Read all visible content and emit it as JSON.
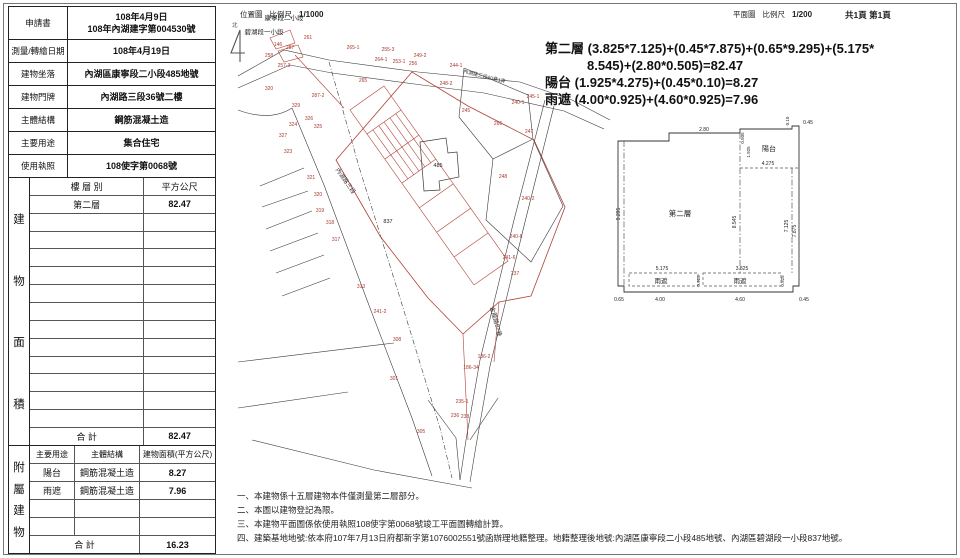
{
  "header": {
    "location_map": "位置圖",
    "scale_label": "比例尺",
    "location_scale": "1/1000",
    "plan_map": "平面圖",
    "plan_scale": "1/200",
    "page_info": "共1頁 第1頁",
    "north": "北"
  },
  "info_table": {
    "rows": [
      {
        "label": "申請書",
        "value": "108年4月9日\n108年內湖建字第004530號"
      },
      {
        "label": "測量/轉繪日期",
        "value": "108年4月19日"
      },
      {
        "label": "建物坐落",
        "value": "內湖區康寧段二小段485地號"
      },
      {
        "label": "建物門牌",
        "value": "內湖路三段36號二樓"
      },
      {
        "label": "主體結構",
        "value": "鋼筋混凝土造"
      },
      {
        "label": "主要用途",
        "value": "集合住宅"
      },
      {
        "label": "使用執照",
        "value": "108使字第0068號"
      }
    ]
  },
  "area_table": {
    "side_label": "建物面積",
    "col_floor": "樓 層 別",
    "col_area": "平方公尺",
    "rows": [
      {
        "floor": "第二層",
        "area": "82.47"
      }
    ],
    "empty_row_count": 12,
    "total_label": "合  計",
    "total": "82.47"
  },
  "annex_table": {
    "side_label": "附屬建物",
    "cols": [
      "主要用途",
      "主體結構",
      "建物面積(平方公尺)"
    ],
    "rows": [
      {
        "use": "陽台",
        "structure": "鋼筋混凝土造",
        "area": "8.27"
      },
      {
        "use": "雨遮",
        "structure": "鋼筋混凝土造",
        "area": "7.96"
      }
    ],
    "empty_row_count": 2,
    "total_label": "合  計",
    "total": "16.23"
  },
  "formula": {
    "lines": [
      "第二層 (3.825*7.125)+(0.45*7.875)+(0.65*9.295)+(5.175*",
      "8.545)+(2.80*0.505)=82.47",
      "陽台 (1.925*4.275)+(0.45*0.10)=8.27",
      "雨遮 (4.00*0.925)+(4.60*0.925)=7.96"
    ]
  },
  "site_map": {
    "section_labels": [
      {
        "t": "康寧段二小段",
        "x": 52,
        "y": 10
      },
      {
        "t": "碧湖段一小段",
        "x": 32,
        "y": 24
      }
    ],
    "road_labels": [
      {
        "t": "內湖路三段",
        "x": 112,
        "y": 172,
        "r": 55,
        "size": 6
      },
      {
        "t": "內湖路三段60巷1弄",
        "x": 252,
        "y": 68,
        "r": 14,
        "size": 5
      },
      {
        "t": "金龍路87巷",
        "x": 262,
        "y": 312,
        "r": 75,
        "size": 6
      }
    ],
    "parcel_labels": [
      {
        "t": "146",
        "x": 46,
        "y": 36
      },
      {
        "t": "258",
        "x": 37,
        "y": 47
      },
      {
        "t": "287",
        "x": 58,
        "y": 39
      },
      {
        "t": "261",
        "x": 76,
        "y": 29
      },
      {
        "t": "257-3",
        "x": 52,
        "y": 57
      },
      {
        "t": "265-1",
        "x": 121,
        "y": 39
      },
      {
        "t": "255-3",
        "x": 156,
        "y": 41
      },
      {
        "t": "264-1",
        "x": 149,
        "y": 51
      },
      {
        "t": "253-1",
        "x": 167,
        "y": 53
      },
      {
        "t": "256",
        "x": 181,
        "y": 55
      },
      {
        "t": "249-2",
        "x": 188,
        "y": 47
      },
      {
        "t": "244-1",
        "x": 224,
        "y": 57
      },
      {
        "t": "265",
        "x": 131,
        "y": 72
      },
      {
        "t": "248-2",
        "x": 214,
        "y": 75
      },
      {
        "t": "245",
        "x": 234,
        "y": 102
      },
      {
        "t": "245-1",
        "x": 301,
        "y": 88
      },
      {
        "t": "240-1",
        "x": 286,
        "y": 94
      },
      {
        "t": "266",
        "x": 266,
        "y": 115
      },
      {
        "t": "247",
        "x": 297,
        "y": 123
      },
      {
        "t": "248",
        "x": 271,
        "y": 168
      },
      {
        "t": "240-2",
        "x": 296,
        "y": 190
      },
      {
        "t": "240-6",
        "x": 284,
        "y": 228
      },
      {
        "t": "241-6",
        "x": 277,
        "y": 249
      },
      {
        "t": "237",
        "x": 283,
        "y": 265
      },
      {
        "t": "320",
        "x": 37,
        "y": 80
      },
      {
        "t": "329",
        "x": 64,
        "y": 97
      },
      {
        "t": "287-2",
        "x": 86,
        "y": 87
      },
      {
        "t": "326",
        "x": 77,
        "y": 110
      },
      {
        "t": "324",
        "x": 61,
        "y": 116
      },
      {
        "t": "325",
        "x": 86,
        "y": 118
      },
      {
        "t": "327",
        "x": 51,
        "y": 127
      },
      {
        "t": "323",
        "x": 56,
        "y": 143
      },
      {
        "t": "321",
        "x": 79,
        "y": 169
      },
      {
        "t": "320",
        "x": 86,
        "y": 186
      },
      {
        "t": "319",
        "x": 88,
        "y": 202
      },
      {
        "t": "318",
        "x": 98,
        "y": 214
      },
      {
        "t": "317",
        "x": 104,
        "y": 231
      },
      {
        "t": "313",
        "x": 129,
        "y": 278
      },
      {
        "t": "241-2",
        "x": 148,
        "y": 303
      },
      {
        "t": "308",
        "x": 165,
        "y": 331
      },
      {
        "t": "301",
        "x": 162,
        "y": 370
      },
      {
        "t": "305",
        "x": 189,
        "y": 423
      },
      {
        "t": "186-2",
        "x": 252,
        "y": 348
      },
      {
        "t": "186-34",
        "x": 239,
        "y": 359
      },
      {
        "t": "235-1",
        "x": 230,
        "y": 393
      },
      {
        "t": "236",
        "x": 223,
        "y": 407
      },
      {
        "t": "238",
        "x": 233,
        "y": 408
      },
      {
        "t": "485",
        "x": 206,
        "y": 157,
        "c": "#222222",
        "size": 5.5
      },
      {
        "t": "837",
        "x": 156,
        "y": 213,
        "c": "#222222",
        "size": 5.5
      }
    ]
  },
  "floor_plan": {
    "labels": [
      {
        "t": "2.80",
        "x": 92,
        "y": 21
      },
      {
        "t": "0.505",
        "x": 132,
        "y": 28,
        "r": -90,
        "size": 4.5
      },
      {
        "t": "1.925",
        "x": 138,
        "y": 42,
        "r": -90,
        "size": 4.5
      },
      {
        "t": "0.10",
        "x": 177,
        "y": 11,
        "r": -90,
        "size": 4.5
      },
      {
        "t": "0.45",
        "x": 196,
        "y": 14
      },
      {
        "t": "陽台",
        "x": 157,
        "y": 41,
        "size": 7
      },
      {
        "t": "4.275",
        "x": 156,
        "y": 55
      },
      {
        "t": "第二層",
        "x": 68,
        "y": 106,
        "size": 7.5
      },
      {
        "t": "9.295",
        "x": 8,
        "y": 104,
        "r": -90
      },
      {
        "t": "8.545",
        "x": 124,
        "y": 112,
        "r": -90
      },
      {
        "t": "7.125",
        "x": 176,
        "y": 116,
        "r": -90
      },
      {
        "t": "7.875",
        "x": 184,
        "y": 121,
        "r": -90
      },
      {
        "t": "5.175",
        "x": 50,
        "y": 160
      },
      {
        "t": "3.825",
        "x": 130,
        "y": 160
      },
      {
        "t": "0.925",
        "x": 88,
        "y": 171,
        "r": -90,
        "size": 4.5
      },
      {
        "t": "0.925",
        "x": 172,
        "y": 171,
        "r": -90,
        "size": 4.5
      },
      {
        "t": "雨遮",
        "x": 49,
        "y": 173,
        "size": 6.5
      },
      {
        "t": "雨遮",
        "x": 128,
        "y": 173,
        "size": 6.5
      },
      {
        "t": "0.65",
        "x": 7,
        "y": 191
      },
      {
        "t": "4.00",
        "x": 48,
        "y": 191
      },
      {
        "t": "4.60",
        "x": 128,
        "y": 191
      },
      {
        "t": "0.45",
        "x": 192,
        "y": 191
      }
    ]
  },
  "notes": [
    "一、本建物係十五層建物本件僅測量第二層部分。",
    "二、本圖以建物登記為限。",
    "三、本建物平面圖係依使用執照108使字第0068號竣工平面圖轉繪計算。",
    "四、建築基地地號:依本府107年7月13日府都新字第1076002551號函辦理地籍整理。地籍整理後地號:內湖區康寧段二小段485地號、內湖區碧湖段一小段837地號。"
  ],
  "colors": {
    "red_line": "#b04238",
    "red_text": "#a8382e",
    "black_line": "#3a3a3a"
  }
}
